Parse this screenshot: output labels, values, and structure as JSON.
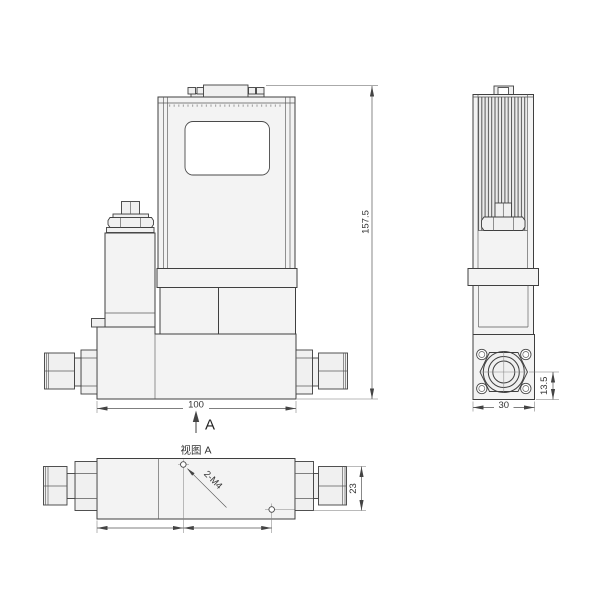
{
  "drawing": {
    "colors": {
      "line": "#3f3f3f",
      "fill": "#f3f3f3",
      "background": "#ffffff"
    },
    "front": {
      "dim_height": "157.5",
      "dim_width": "100",
      "view_arrow_label": "A"
    },
    "side": {
      "dim_depth": "30",
      "dim_port_offset": "13.5"
    },
    "bottom_view": {
      "title": "视图 A",
      "thread_note": "2-M4",
      "dim_fitting_width": "23"
    }
  }
}
